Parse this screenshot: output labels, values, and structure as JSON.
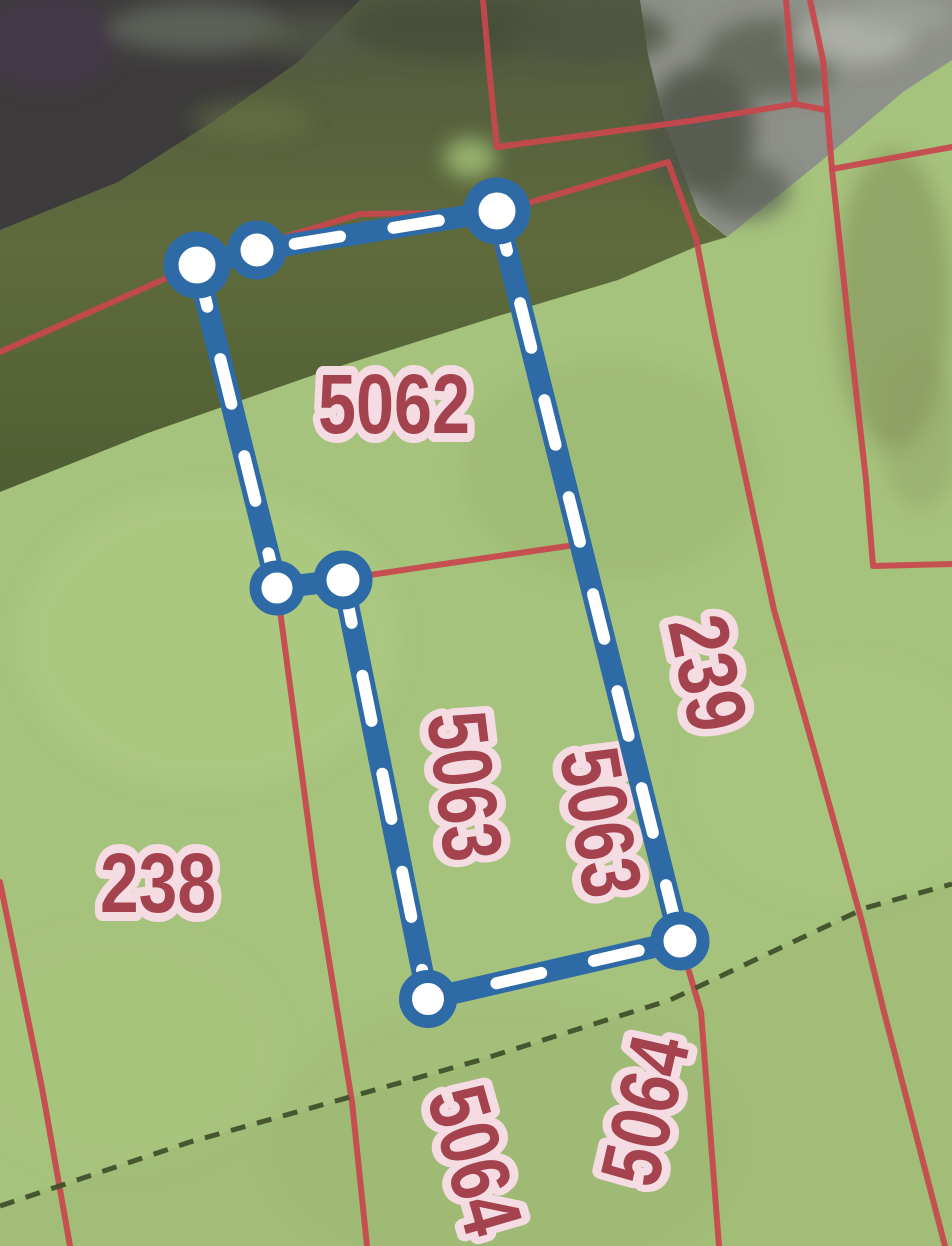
{
  "map": {
    "parcel_labels": [
      {
        "text": "5062"
      },
      {
        "text": "238"
      },
      {
        "text": "239"
      },
      {
        "text": "5063"
      },
      {
        "text": "5063"
      },
      {
        "text": "5064"
      },
      {
        "text": "5064"
      }
    ],
    "selection": {
      "vertex_count": 7,
      "line_style": "blue-with-white-dashes"
    },
    "colors": {
      "parcel_boundary_red": "#c8474e",
      "selection_blue": "#2e6ba6",
      "selection_dash_white": "#ffffff",
      "label_text_red": "#a4424e",
      "label_halo_pink": "#f5dbe2",
      "landuse_green": "#a6c37d",
      "boundary_dash_dark": "#41502a"
    }
  }
}
